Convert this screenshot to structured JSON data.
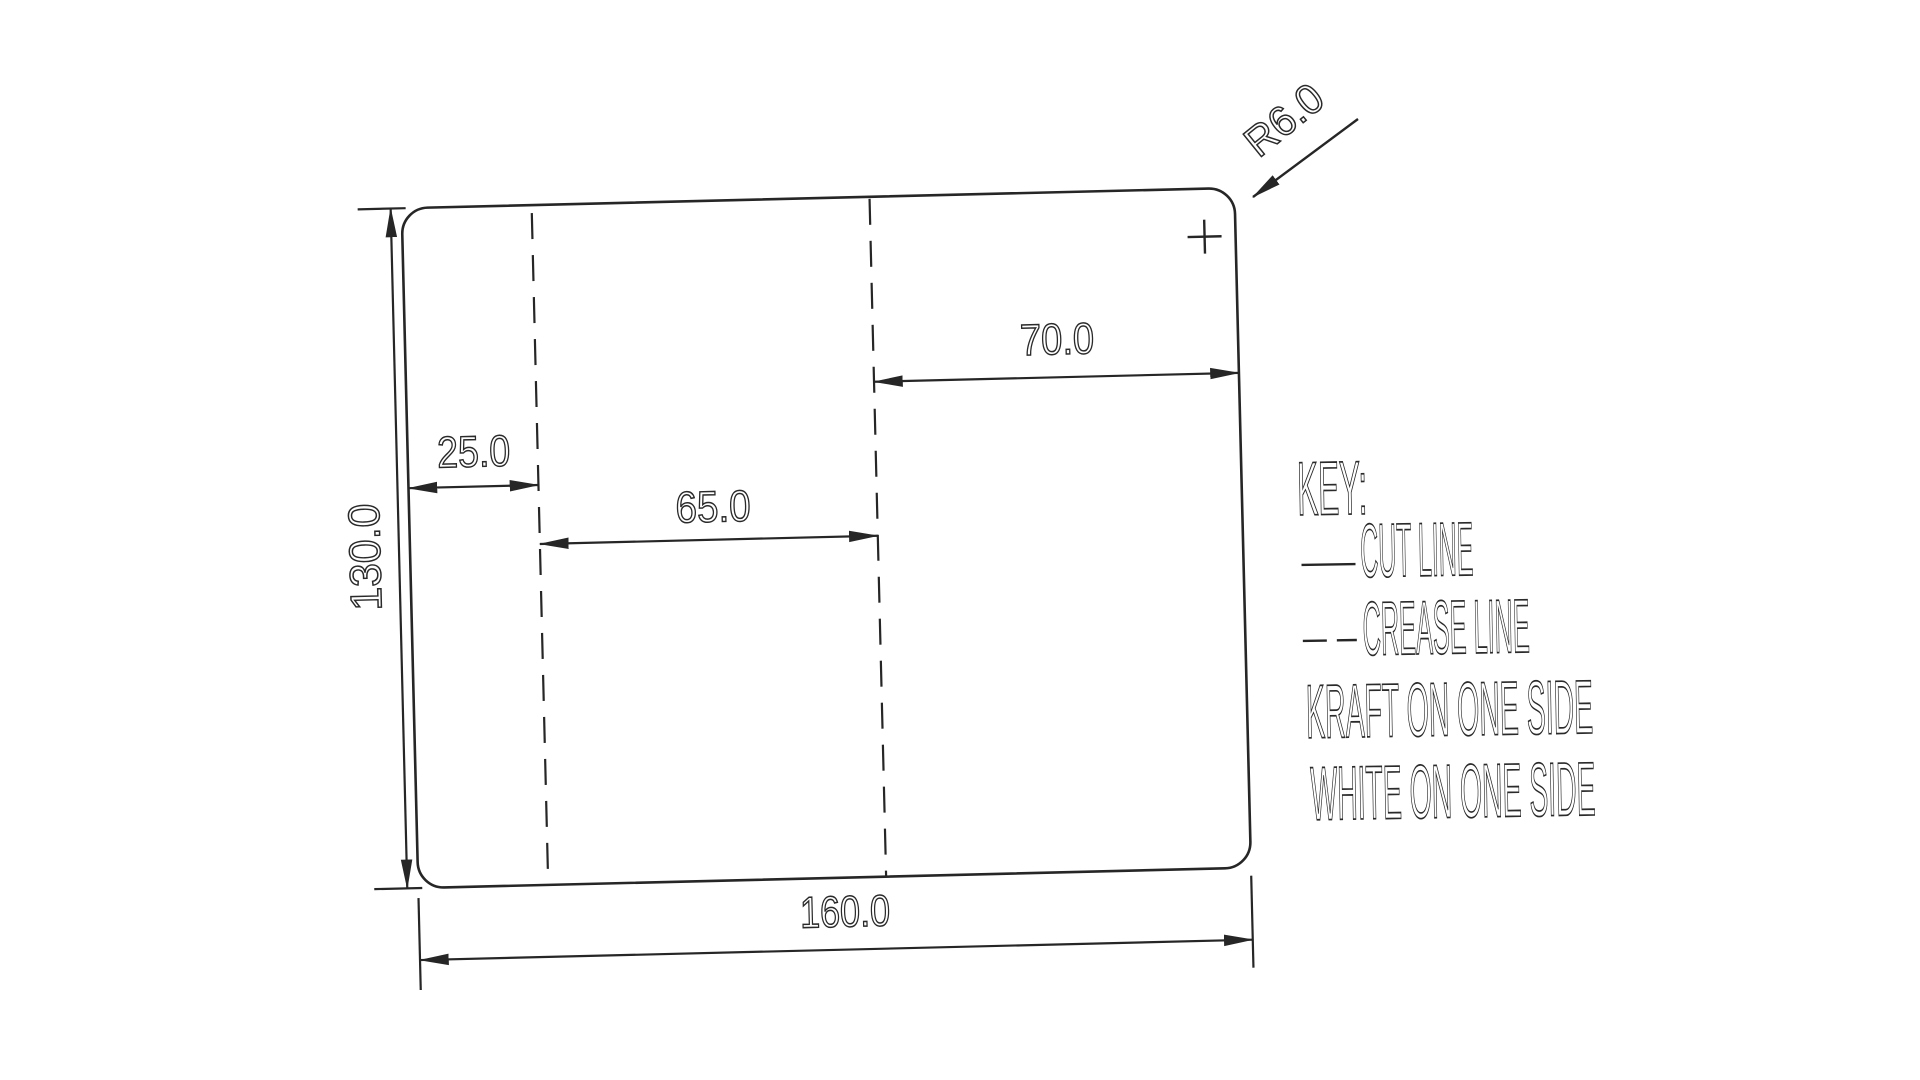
{
  "dieline": {
    "description": "carton dieline drawing",
    "line_color": "#262626",
    "background_color": "#ffffff",
    "dimensions": {
      "total_width": "160.0",
      "total_height": "130.0",
      "left_panel_width": "25.0",
      "middle_panel_width": "65.0",
      "right_panel_width": "70.0",
      "corner_radius": "R6.0"
    }
  },
  "legend": {
    "title": "KEY:",
    "items": [
      {
        "label": "CUT LINE",
        "line_style": "solid"
      },
      {
        "label": "CREASE LINE",
        "line_style": "dashed"
      }
    ],
    "notes": [
      "KRAFT ON ONE SIDE",
      "WHITE ON ONE SIDE"
    ]
  }
}
